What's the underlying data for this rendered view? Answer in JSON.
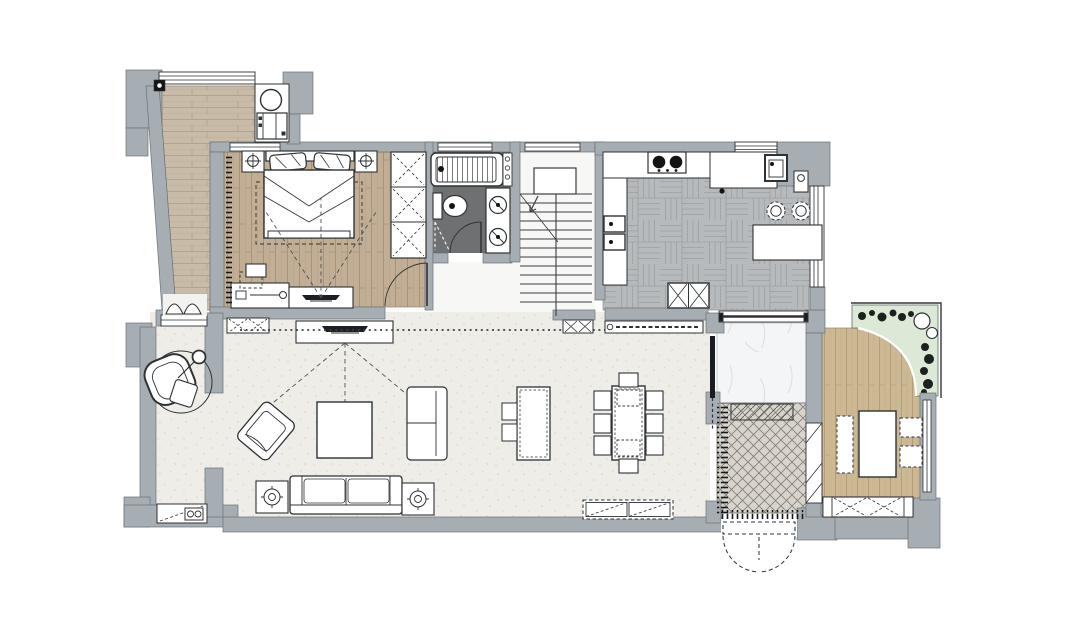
{
  "document": {
    "type": "residential-floor-plan",
    "background": "#ffffff"
  },
  "palette": {
    "wall": "#a7aeb3",
    "wall_outline": "#6b7277",
    "line": "#2e3234",
    "balcony_wood": "#c8bba7",
    "bedroom_wood": "#c1ae95",
    "tea_wood": "#cdb894",
    "kitchen_parquet": "#b7babc",
    "living_floor": "#efede8",
    "hall_floor": "#f7f7f5",
    "bath_tile": "#6f7071",
    "marble": "#f4f5f6",
    "foyer_tile": "#d8d4cc",
    "garden_green": "#dde9d7",
    "plant_black": "#1c211d",
    "furniture_fill": "#ffffff"
  },
  "rooms": [
    {
      "name": "balcony-laundry",
      "floor": "wood-plank"
    },
    {
      "name": "master-bedroom",
      "floor": "wood-plank"
    },
    {
      "name": "bathroom",
      "floor": "dark-tile"
    },
    {
      "name": "stair-hall",
      "floor": "screed"
    },
    {
      "name": "kitchen",
      "floor": "gray-parquet"
    },
    {
      "name": "living-room",
      "floor": "light-screed"
    },
    {
      "name": "dining-area",
      "floor": "light-screed"
    },
    {
      "name": "mudroom-passage",
      "floor": "marble"
    },
    {
      "name": "entry-foyer",
      "floor": "mosaic-tile"
    },
    {
      "name": "tea-room",
      "floor": "wood-plank"
    },
    {
      "name": "planter-garden",
      "floor": "greenery"
    }
  ],
  "furniture": {
    "balcony": [
      "washing-machine",
      "laundry-cabinet",
      "floor-drain",
      "bifold-door",
      "window"
    ],
    "master_bedroom": [
      "double-bed",
      "pillows",
      "nightstand-left",
      "nightstand-right",
      "ceiling-lamp-symbols",
      "area-rug",
      "wardrobe",
      "desk",
      "desk-chair",
      "dresser",
      "tv-console",
      "tv",
      "curtain",
      "door-swing"
    ],
    "bathroom": [
      "bathtub",
      "toiletry-shelf",
      "toilet",
      "double-vanity",
      "shower-screen",
      "door-swing"
    ],
    "stair_hall": [
      "staircase",
      "landing",
      "direction-arrow"
    ],
    "kitchen": [
      "gas-hob",
      "top-counter",
      "side-counter",
      "prep-sink",
      "double-sink",
      "bar-counter",
      "bar-stools",
      "refrigerator",
      "windows"
    ],
    "living_room": [
      "hanging-egg-chair",
      "round-rug",
      "media-cabinet",
      "tv-console",
      "tv",
      "armchair",
      "coffee-table",
      "chaise-seat",
      "sofa",
      "speaker-side-tables",
      "beverage-counter",
      "sightlines",
      "beam-dotted-line"
    ],
    "dining_area": [
      "island-table",
      "island-stools",
      "dining-table",
      "dining-chairs",
      "sideboard",
      "wall-cabinet"
    ],
    "mudroom_passage": [
      "sliding-door",
      "window"
    ],
    "entry_foyer": [
      "doormat",
      "double-entry-door",
      "side-door-panel"
    ],
    "tea_room": [
      "tea-table",
      "bench",
      "floor-cushions",
      "low-cabinet",
      "window"
    ],
    "garden": [
      "planter-strip",
      "plants",
      "plant-pots"
    ]
  }
}
